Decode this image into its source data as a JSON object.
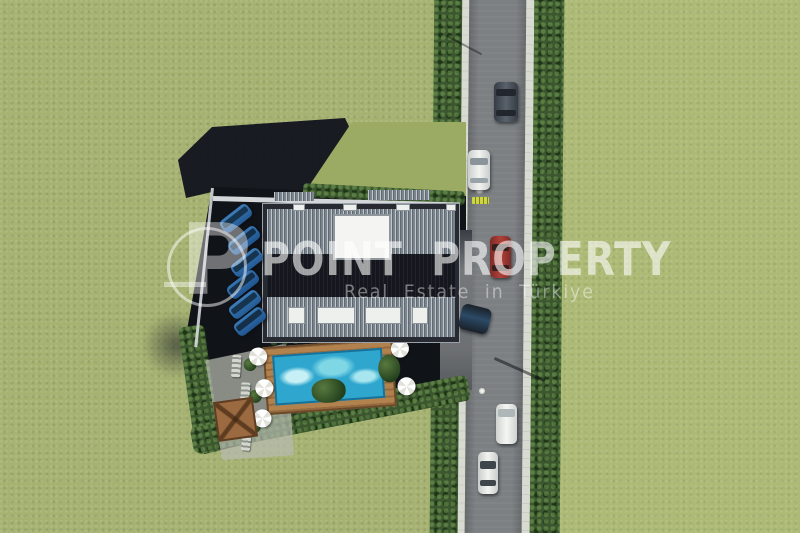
{
  "meta": {
    "type": "aerial-3d-architectural-render",
    "description": "Top-down 3D render of a residential project: building with corrugated roof and skylight, pool terrace with umbrellas and pergola, parking row with blue cars, vertical tree-lined road with traffic, surrounded by green fields"
  },
  "watermark": {
    "logo_letter": "P",
    "title": "POINT PROPERTY",
    "subtitle": "Real Estate in Türkiye",
    "text_color": "#ffffff"
  },
  "scene": {
    "grass_color": "#a5b271",
    "shadow_color": "#10141d",
    "road": {
      "asphalt_color": "#7c8083",
      "sidewalk_color": "#d8dbd2",
      "hedge_color": "#3c572f",
      "marking_color": "#cdd63e",
      "cars": [
        {
          "name": "dark-sedan",
          "color": "#474f57"
        },
        {
          "name": "white-car-north",
          "color": "#e6e8e6"
        },
        {
          "name": "red-car",
          "color": "#a23a33"
        },
        {
          "name": "car-entering-driveway",
          "color": "#222a35"
        },
        {
          "name": "white-van",
          "color": "#eceeeb"
        },
        {
          "name": "white-car-south",
          "color": "#e6e8e6"
        }
      ],
      "street_lamps": 2
    },
    "building": {
      "roof_color": "#79848d",
      "courtyard_color": "#14171d",
      "skylight_color": "#eef0ed",
      "balcony_count": 4
    },
    "pool_terrace": {
      "water_color": "#2fa6cd",
      "deck_color": "#b2824e",
      "pergola_color": "#9c6a40",
      "umbrella_count": 5,
      "lounger_count": 4
    },
    "parking": {
      "parked_car_color": "#2e6cab",
      "parked_car_count": 6
    }
  }
}
